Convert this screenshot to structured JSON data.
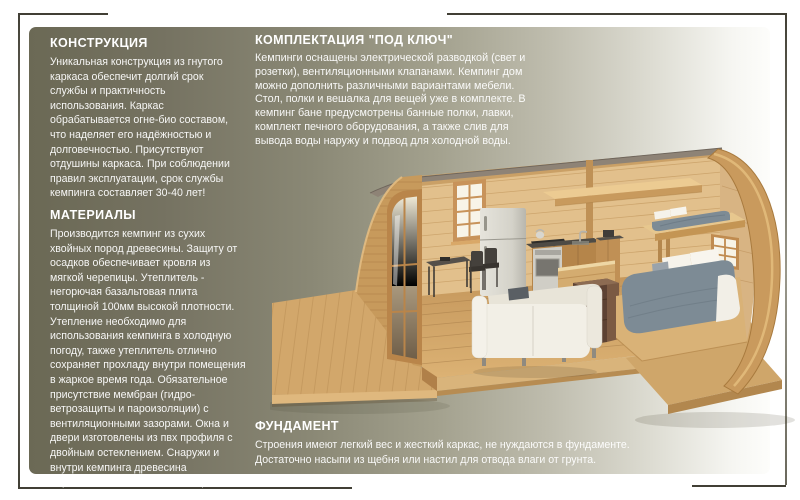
{
  "page": {
    "background": "#ffffff",
    "frame_color": "#413f35",
    "card_gradient_left": "#6b6955",
    "card_gradient_right": "#fdfdfb",
    "text_color": "#ffffff"
  },
  "sections": {
    "construction": {
      "title": "КОНСТРУКЦИЯ",
      "body": "Уникальная конструкция из гнутого каркаса обеспечит долгий срок службы и практичность использования. Каркас обрабатывается огне-био составом, что наделяет его надёжностью и долговечностью. Присутствуют отдушины каркаса. При соблюдении правил эксплуатации, срок службы кемпинга составляет 30-40 лет!"
    },
    "materials": {
      "title": "МАТЕРИАЛЫ",
      "body": "Производится кемпинг из сухих хвойных пород древесины. Защиту от осадков обеспечивает кровля из мягкой черепицы.  Утеплитель - негорючая базальтовая плита толщиной 100мм высокой плотности. Утепление необходимо для использования кемпинга в холодную погоду, также утеплитель отлично сохраняет прохладу внутри помещения в жаркое время года. Обязательное присутствие мембран (гидро-ветрозащиты и пароизоляции) с вентиляционными зазорами. Окна и двери изготовлены из пвх профиля с двойным остеклением. Снаружи и внутри кемпинга древесина обработана экологичными  защитными материалами."
    },
    "turnkey": {
      "title": "КОМПЛЕКТАЦИЯ \"ПОД КЛЮЧ\"",
      "body": "Кемпинги оснащены электрической разводкой (свет и розетки), вентиляционными клапанами. Кемпинг дом можно дополнить различными вариантами мебели. Стол, полки и вешалка для вещей уже в комплекте. В кемпинг бане предусмотрены банные полки, лавки, комплект печного оборудования, а также слив для вывода воды наружу и подвод для холодной воды."
    },
    "foundation": {
      "title": "ФУНДАМЕНТ",
      "body": "Строения имеют легкий вес и жесткий каркас, не нуждаются в фундаменте. Достаточно насыпи из щебня или настил для отвода влаги от грунта."
    }
  },
  "illustration": {
    "subject": "кемпинг дом - разрез",
    "wood_color": "#c79a5c",
    "bedding_color": "#7d8b95",
    "sofa_color": "#f1eee5"
  }
}
